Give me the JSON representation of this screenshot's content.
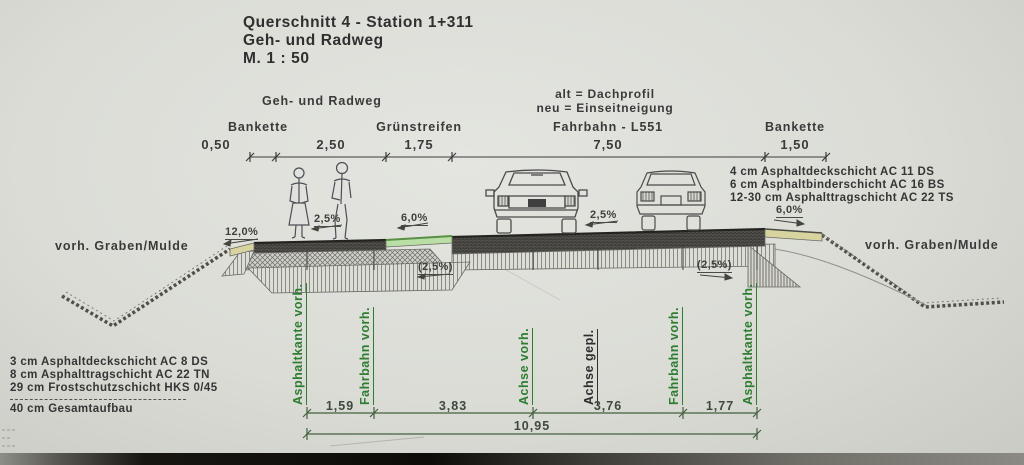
{
  "title": {
    "line1": "Querschnitt 4  -  Station 1+311",
    "line2": "Geh- und Radweg",
    "line3": "M. 1 : 50"
  },
  "header": {
    "path_label": "Geh- und Radweg",
    "note1": "alt = Dachprofil",
    "note2": "neu = Einseitneigung"
  },
  "dims_top": {
    "bankette_l_label": "Bankette",
    "bankette_l_value": "0,50",
    "path_value": "2,50",
    "gruenstreifen_label": "Grünstreifen",
    "gruenstreifen_value": "1,75",
    "fahrbahn_label": "Fahrbahn - L551",
    "fahrbahn_value": "7,50",
    "bankette_r_label": "Bankette",
    "bankette_r_value": "1,50"
  },
  "slopes": {
    "embankment_left": "12,0%",
    "path": "2,5%",
    "gruenstreifen": "6,0%",
    "road": "2,5%",
    "bankette_right": "6,0%",
    "existing_left": "(2,5%)",
    "existing_right": "(2,5%)"
  },
  "ditch": {
    "left": "vorh. Graben/Mulde",
    "right": "vorh. Graben/Mulde"
  },
  "road_layers": {
    "l1": "4 cm Asphaltdeckschicht AC 11 DS",
    "l2": "6 cm Asphaltbinderschicht AC 16 BS",
    "l3": "12-30 cm Asphalttragschicht AC 22 TS"
  },
  "path_layers": {
    "l1": "3 cm Asphaltdeckschicht AC 8 DS",
    "l2": "8 cm Asphalttragschicht AC 22 TN",
    "l3": "29 cm Frostschutzschicht HKS 0/45",
    "total": "40 cm Gesamtaufbau"
  },
  "axes": {
    "a1": "Asphaltkante vorh.",
    "a2": "Fahrbahn vorh.",
    "a3": "Achse vorh.",
    "a4": "Achse gepl.",
    "a5": "Fahrbahn vorh.",
    "a6": "Asphaltkante vorh.",
    "color_existing": "#2e7d32",
    "color_planned": "#2e2e2e"
  },
  "dims_bottom": {
    "d1": "1,59",
    "d2": "3,83",
    "d3": "3,76",
    "d4": "1,77",
    "total": "10,95"
  },
  "colors": {
    "green_strip": "#b9dfa6",
    "bankette_tan": "#d8d4a0",
    "dim_green": "#44603f",
    "ink": "#3a3a3a"
  }
}
